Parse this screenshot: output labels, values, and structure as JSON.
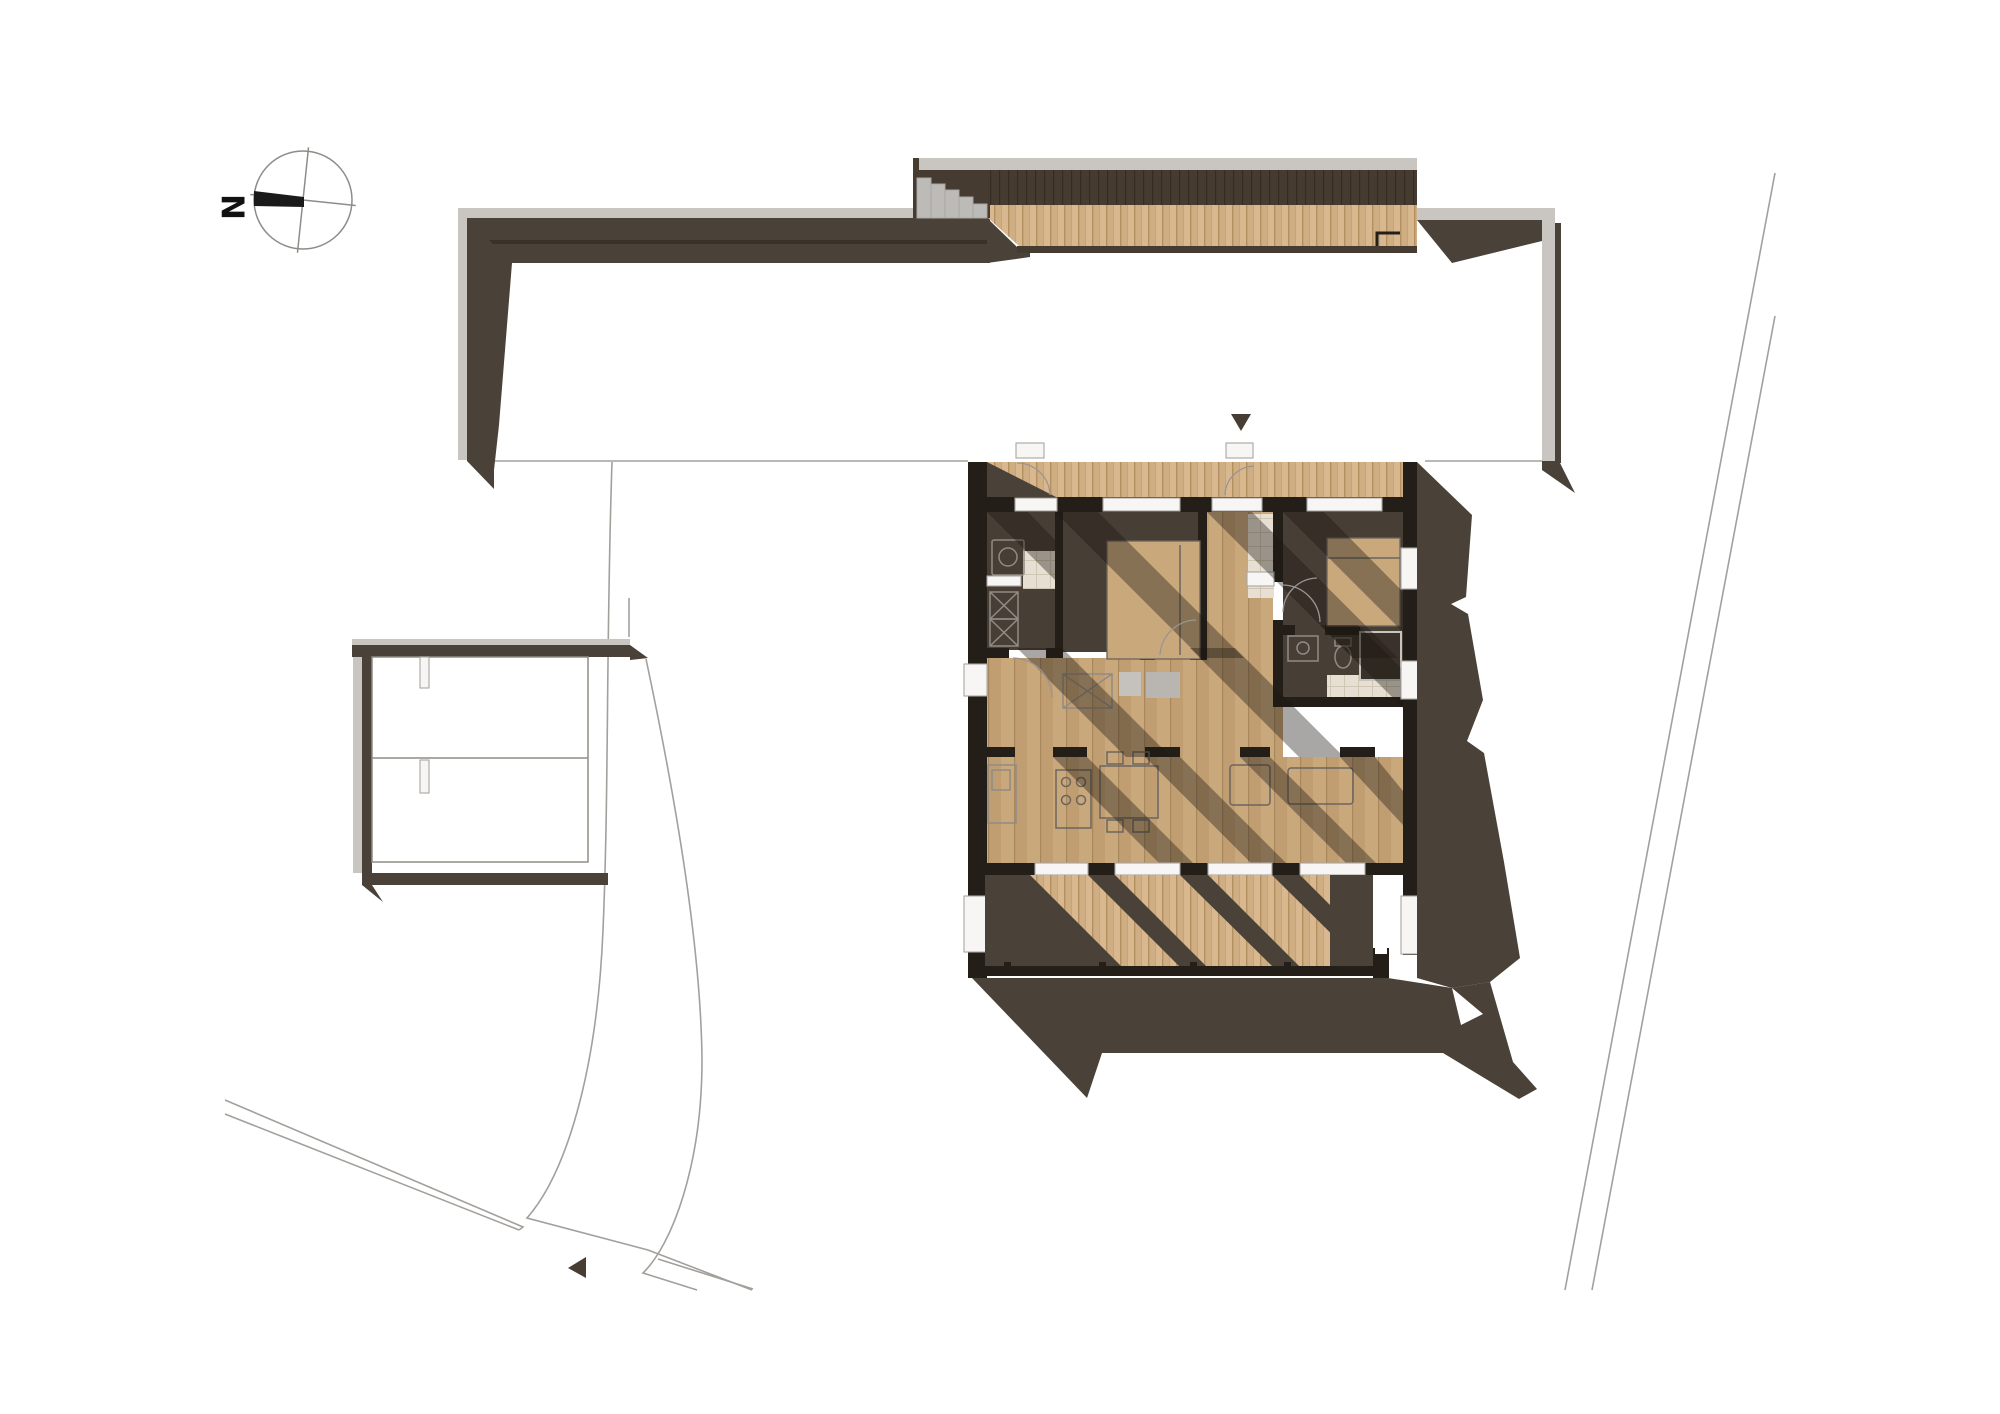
{
  "compass": {
    "label": "N"
  },
  "icons": {
    "north_arrow": "compass-rose",
    "entry_marker_glyph": "▼",
    "path_marker_glyph": "◀"
  },
  "colors": {
    "wall_dark": "#241e19",
    "brown": "#4a4138",
    "brown_line": "#3a322a",
    "concrete": "#c9c6c2",
    "concrete_edge": "#a9a6a2",
    "steps": "#bdbbb8",
    "wood_deck": "#d9b88f",
    "wood_deck2": "#cfae83",
    "wood_deck_line": "#b3905f",
    "wood_floor": "#c9a87c",
    "wood_floor2": "#c19e72",
    "wood_floor_line": "#a8875c",
    "dark_slat": "#453b31",
    "dark_slat_line": "#342b23",
    "tile": "#e6dfd2",
    "tile_line": "#cfc6b4",
    "interior_dark_floor": "#473e35",
    "shadow_overlay": "rgba(30,24,19,0.38)",
    "site_line": "#a3a09c",
    "compass_line": "#8f8c88",
    "fixture_line_light": "#908b85",
    "fixture_line_dark": "#6b655e",
    "arc_line": "#9a9590"
  }
}
